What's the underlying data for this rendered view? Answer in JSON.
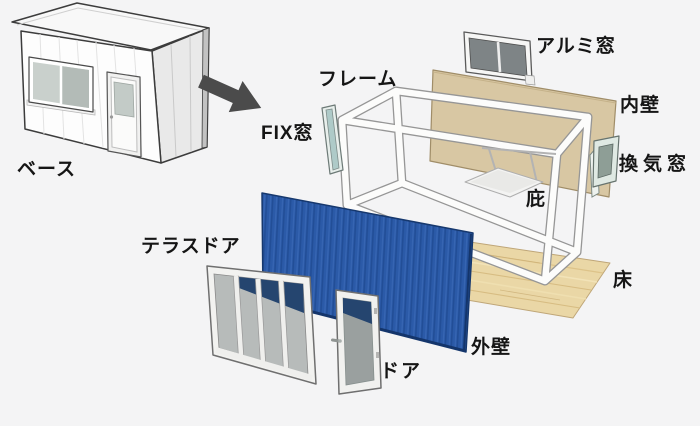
{
  "diagram": "container-house-exploded-view",
  "labels": {
    "base": "ベース",
    "frame": "フレーム",
    "fix_window": "FIX窓",
    "aluminum_window": "アルミ窓",
    "inner_wall": "内壁",
    "vent_window": "換気窓",
    "eaves": "庇",
    "floor": "床",
    "terrace_door": "テラスドア",
    "outer_wall": "外壁",
    "door": "ドア"
  },
  "colors": {
    "background": "#f4f4f5",
    "outer_wall_blue": "#2b5aa8",
    "inner_wall_tan": "#d8c7a3",
    "floor_wood": "#ead7a6",
    "frame_white": "#fcfcfb",
    "arrow_gray": "#4b4b4b",
    "label_text": "#151515"
  }
}
